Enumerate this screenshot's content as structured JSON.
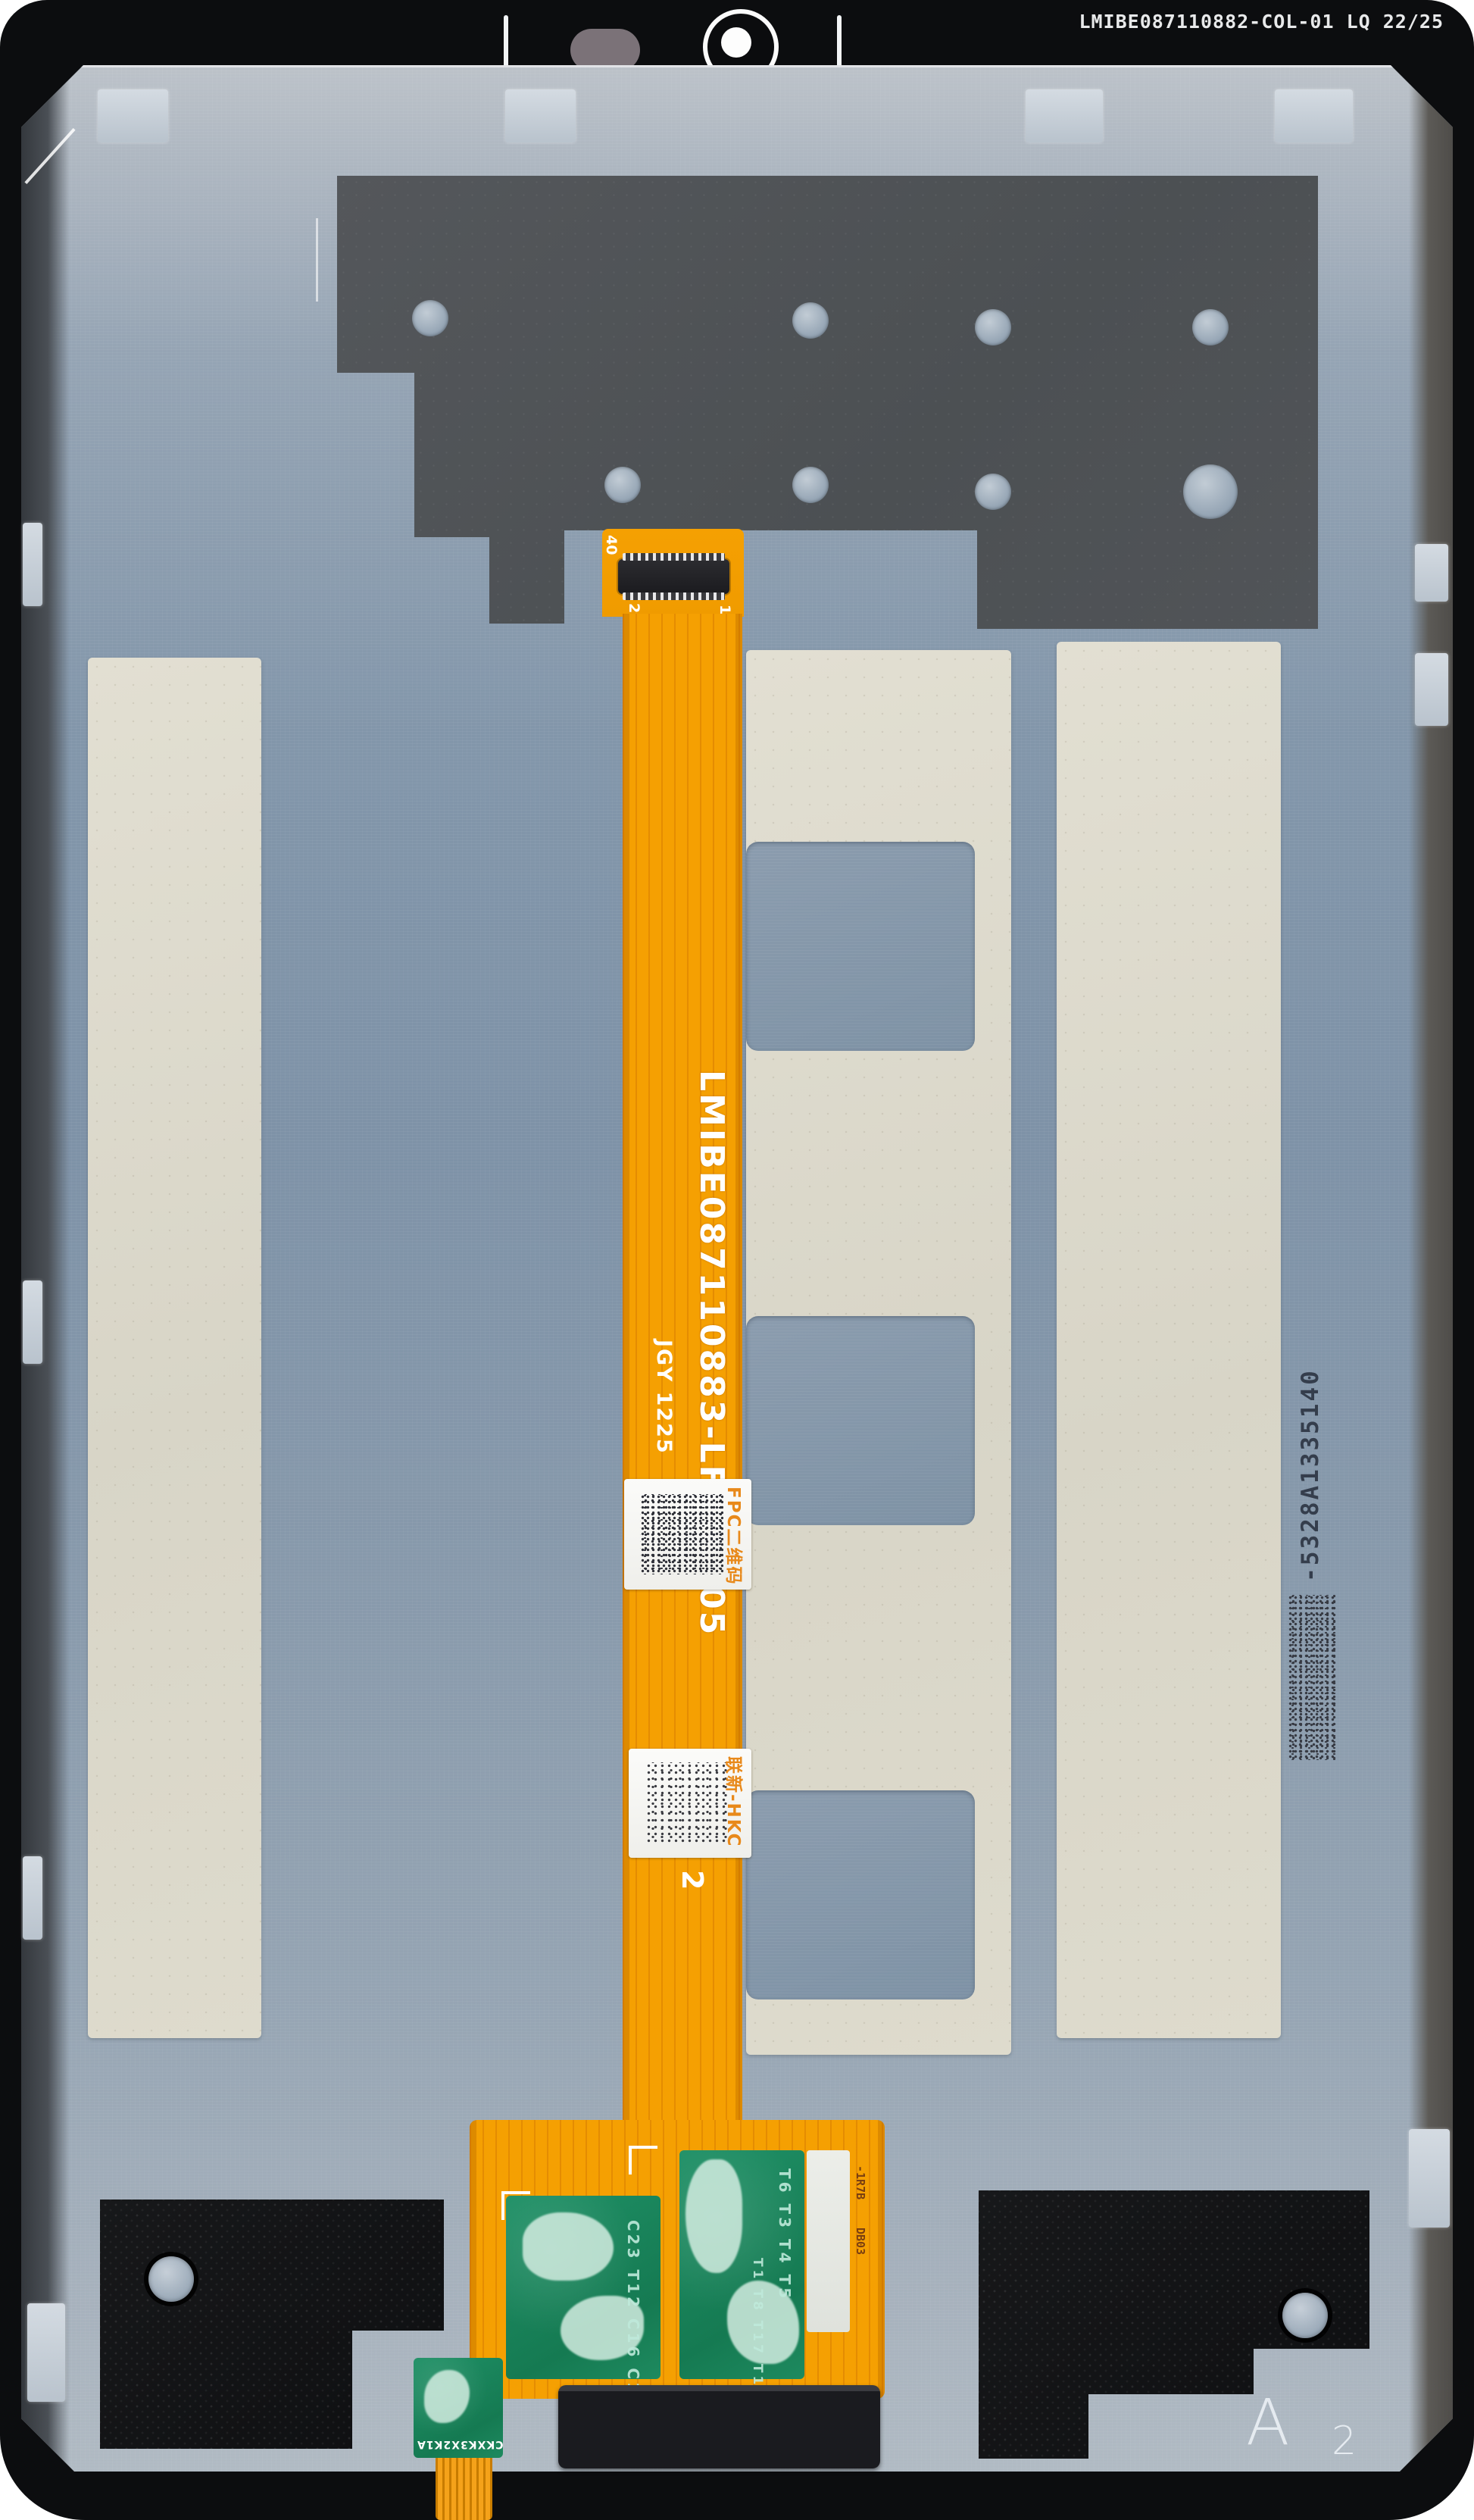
{
  "bezel": {
    "frame_code": "LMIBE087110882-COL-01 LQ 22/25"
  },
  "flex": {
    "main_code": "LMIBE087110883-LFPC-105",
    "date_code": "JGY 1225",
    "pin_top": "40",
    "pin_left": "20",
    "pin_right": "1",
    "digit_mark": "2",
    "label_fpc_caption": "FPC二维码",
    "label_hkc_caption": "联新-HKC",
    "side_text_1": "-1R7B",
    "side_text_2": "DB03",
    "tail_code": "CKXK3X2K1A",
    "left_pcb_refs": "C23 T12 C16 C14",
    "right_pcb_refs": "T6 T3 T4 T5",
    "right_pcb_refs2": "T1 T8 T17 T16"
  },
  "plate": {
    "serial": "-5328A1335140",
    "grade_letter": "A",
    "grade_number": "2"
  },
  "colors": {
    "flex_orange": "#F5A002",
    "metal": "#8296AA",
    "charcoal": "#53575B",
    "cream_sticker": "#DCD9CB",
    "pcb_green": "#1F9066",
    "coating_teal": "#D2ECE0",
    "bezel_black": "#0C0D0F"
  }
}
